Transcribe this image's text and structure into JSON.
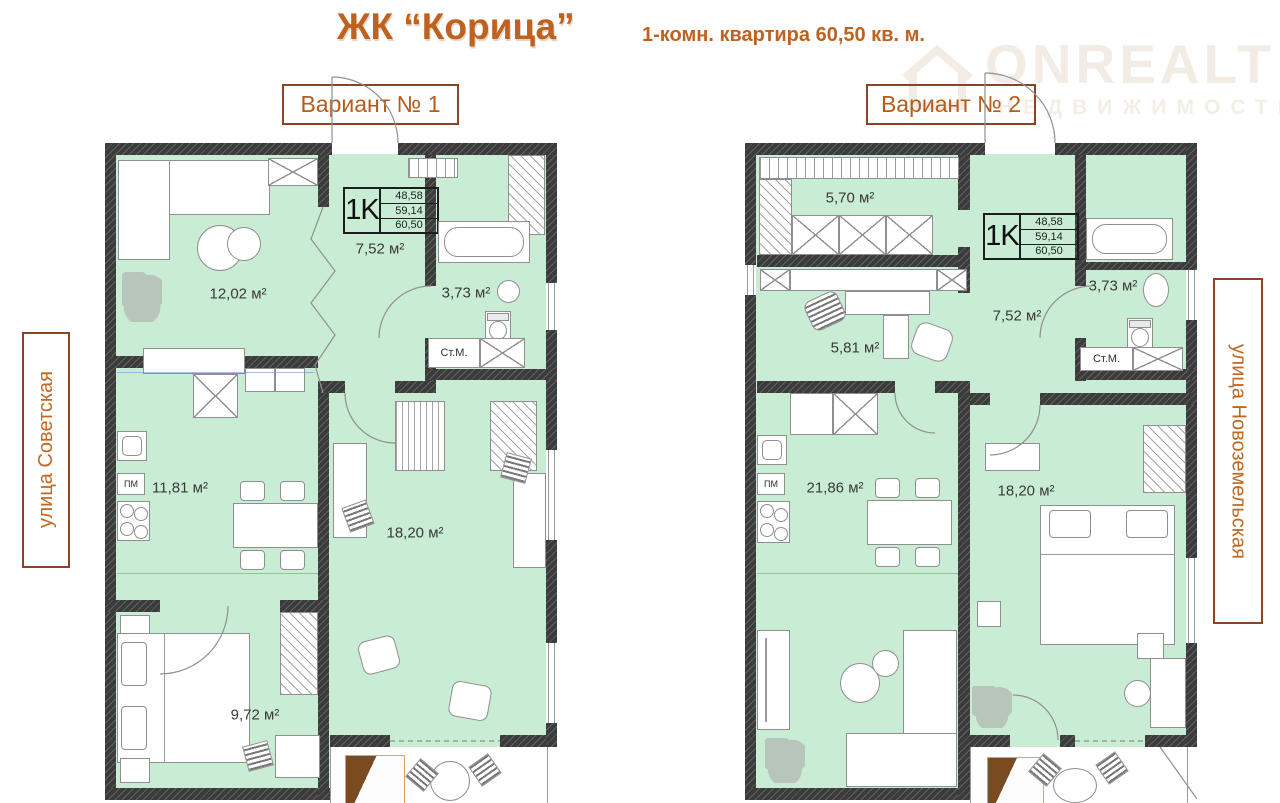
{
  "header": {
    "title": "ЖК “Корица”",
    "subtitle": "1-комн. квартира 60,50 кв. м."
  },
  "watermark": {
    "brand": "ONREALT",
    "tagline": "НЕДВИЖИМОСТЬ"
  },
  "streets": {
    "left": "улица Советская",
    "right": "улица Новоземельская"
  },
  "colors": {
    "accent_orange": "#c2671f",
    "border_brown": "#8a4423",
    "room_green": "#c9ecd4",
    "wall_dark": "#3b3b3b",
    "window_blue": "#6f96d2"
  },
  "plans": [
    {
      "variant_label": "Вариант № 1",
      "info_box": {
        "type": "1K",
        "areas": [
          "48,58",
          "59,14",
          "60,50"
        ]
      },
      "rooms": [
        {
          "name": "living",
          "area": "12,02 м²"
        },
        {
          "name": "hall",
          "area": "7,52 м²"
        },
        {
          "name": "bathroom",
          "area": "3,73 м²"
        },
        {
          "name": "kitchen",
          "area": "11,81 м²"
        },
        {
          "name": "room",
          "area": "18,20 м²"
        },
        {
          "name": "bedroom",
          "area": "9,72 м²"
        }
      ],
      "labels": {
        "washing_machine": "Ст.М.",
        "dishwasher": "ПМ"
      }
    },
    {
      "variant_label": "Вариант № 2",
      "info_box": {
        "type": "1K",
        "areas": [
          "48,58",
          "59,14",
          "60,50"
        ]
      },
      "rooms": [
        {
          "name": "wardrobe-hall",
          "area": "5,70 м²"
        },
        {
          "name": "office",
          "area": "5,81 м²"
        },
        {
          "name": "hall",
          "area": "7,52 м²"
        },
        {
          "name": "bathroom",
          "area": "3,73 м²"
        },
        {
          "name": "kitchen-living",
          "area": "21,86 м²"
        },
        {
          "name": "bedroom",
          "area": "18,20 м²"
        }
      ],
      "labels": {
        "washing_machine": "Ст.М.",
        "dishwasher": "ПМ"
      }
    }
  ]
}
